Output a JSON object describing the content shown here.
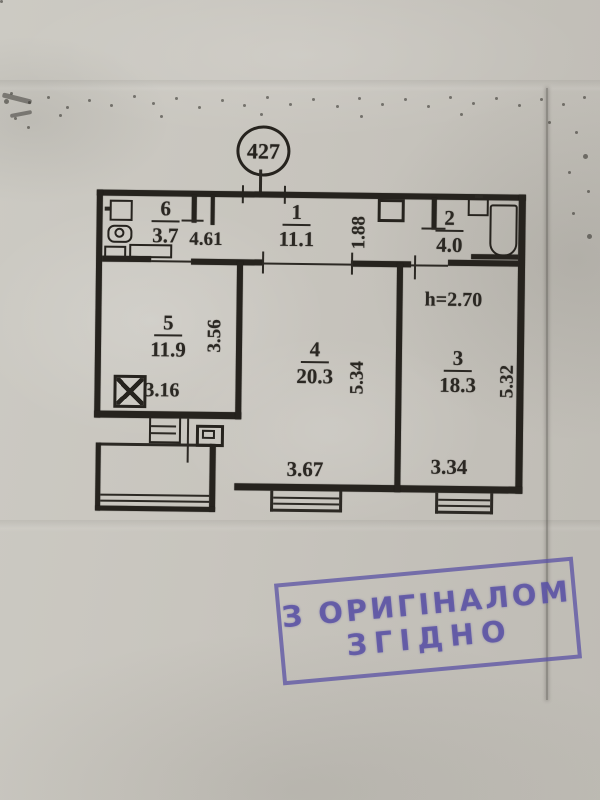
{
  "apartment": {
    "number": "427"
  },
  "rooms": [
    {
      "id": "1",
      "area": "11.1"
    },
    {
      "id": "2",
      "area": "4.0"
    },
    {
      "id": "3",
      "area": "18.3"
    },
    {
      "id": "4",
      "area": "20.3"
    },
    {
      "id": "5",
      "area": "11.9"
    },
    {
      "id": "6",
      "area": "3.7"
    }
  ],
  "dimensions": {
    "hall_width": "4.61",
    "hall_depth": "1.88",
    "room5_depth": "3.56",
    "vent_shaft": "3.16",
    "room4_depth": "5.34",
    "room4_width": "3.67",
    "ceiling_height": "h=2.70",
    "room3_depth": "5.32",
    "room3_width": "3.34"
  },
  "stamp": {
    "line1": "З ОРИГІНАЛОМ",
    "line2": "ЗГІДНО"
  },
  "colors": {
    "ink": "#26231e",
    "stamp": "#5a52a4",
    "paper": "#c8c5be"
  }
}
